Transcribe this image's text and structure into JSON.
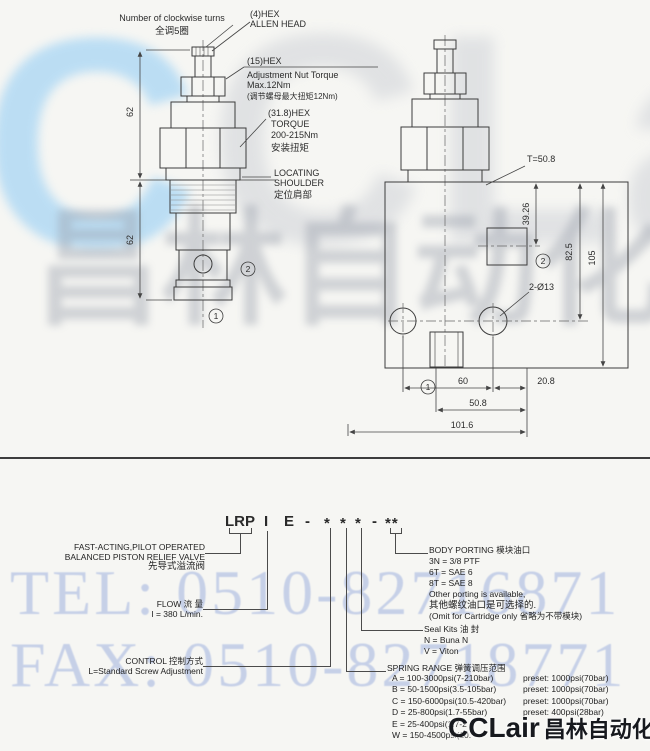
{
  "watermarks": {
    "logo_c_blue": "C",
    "logo_c_gray": "CLair",
    "logo_cn_gray": "昌林自动化",
    "tel": "TEL: 0510-82716871",
    "fax": "FAX: 0510-82718771",
    "brand_front": "CCLair",
    "brand_front_cn": "昌林自动化",
    "colors": {
      "blue": "#abd7f4",
      "gray": "#c3c7cf",
      "cn_gray": "#9aa0ac",
      "telfax": "#b3c1e3",
      "front": "#17191e"
    }
  },
  "drawing_left": {
    "turns_en": "Number of clockwise turns",
    "turns_cn": "全调5圈",
    "allen1": "(4)HEX",
    "allen2": "ALLEN HEAD",
    "nut1": "(15)HEX",
    "nut2": "Adjustment Nut Torque",
    "nut3": "Max.12Nm",
    "nut4": "(调节螺母最大扭矩12Nm)",
    "hex1": "(31.8)HEX",
    "hex2": "TORQUE",
    "hex3": "200-215Nm",
    "hex4": "安装扭矩",
    "loc1": "LOCATING",
    "loc2": "SHOULDER",
    "loc3": "定位肩部",
    "dim_top": "62",
    "dim_bottom": "62",
    "port1": "1",
    "port2": "2"
  },
  "drawing_right": {
    "thread": "T=50.8",
    "dim_a": "39.26",
    "dim_b": "82.5",
    "dim_c": "105",
    "holes": "2-Ø13",
    "dim_60": "60",
    "dim_208": "20.8",
    "dim_508": "50.8",
    "dim_1016": "101.6",
    "port1": "1",
    "port2": "2"
  },
  "model_code": {
    "parts": [
      "LRP",
      "I",
      "E",
      "-",
      "*",
      "*",
      "*",
      "-",
      "**"
    ]
  },
  "labels": {
    "function": {
      "line1": "FAST-ACTING,PILOT OPERATED",
      "line2": "BALANCED PISTON RELIEF VALVE",
      "line3": "先导式溢流阀"
    },
    "flow": {
      "title": "FLOW 流 量",
      "value": "I = 380 L/min."
    },
    "control": {
      "title": "CONTROL 控制方式",
      "value": "L=Standard Screw Adjustment"
    },
    "body_porting": {
      "title": "BODY PORTING 模块油口",
      "opt1": "3N = 3/8 PTF",
      "opt2": "6T = SAE 6",
      "opt3": "8T = SAE 8",
      "note1": "Other porting is available,",
      "note2": "其他螺纹油口是可选择的.",
      "note3": "(Omit for Cartridge only 省略为不带模块)"
    },
    "seal": {
      "title": "Seal Kits 油 封",
      "opt1": "N = Buna N",
      "opt2": "V = Viton"
    },
    "spring": {
      "title": "SPRING RANGE 弹簧调压范围",
      "rows": [
        {
          "range": "A = 100-3000psi(7-210bar)",
          "preset": "preset: 1000psi(70bar)"
        },
        {
          "range": "B = 50-1500psi(3.5-105bar)",
          "preset": "preset: 1000psi(70bar)"
        },
        {
          "range": "C = 150-6000psi(10.5-420bar)",
          "preset": "preset: 1000psi(70bar)"
        },
        {
          "range": "D = 25-800psi(1.7-55bar)",
          "preset": "preset: 400psi(28bar)"
        },
        {
          "range": "E = 25-400psi(1.7-2",
          "preset": ""
        },
        {
          "range": "W = 150-4500psi(10.",
          "preset": ""
        }
      ]
    }
  }
}
